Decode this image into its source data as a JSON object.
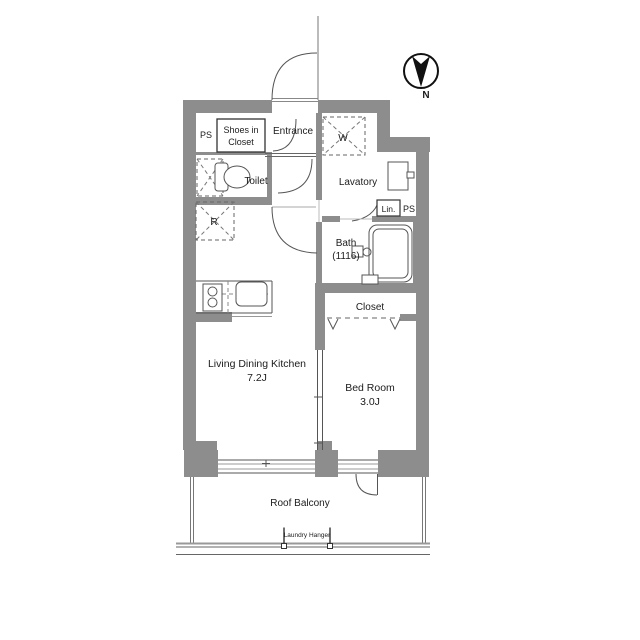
{
  "floorplan": {
    "colors": {
      "wall": "#8d8d8d",
      "line": "#555555",
      "text": "#1c1c1c"
    },
    "compass": {
      "label": "N"
    },
    "rooms": {
      "shoes_in_closet": {
        "line1": "Shoes in",
        "line2": "Closet"
      },
      "entrance": {
        "label": "Entrance"
      },
      "toilet": {
        "label": "Toilet"
      },
      "lavatory": {
        "label": "Lavatory"
      },
      "bath": {
        "line1": "Bath",
        "line2": "(1116)"
      },
      "closet": {
        "label": "Closet"
      },
      "ldk": {
        "line1": "Living Dining Kitchen",
        "line2": "7.2J"
      },
      "bedroom": {
        "line1": "Bed Room",
        "line2": "3.0J"
      },
      "balcony": {
        "label": "Roof Balcony"
      }
    },
    "annotations": {
      "ps_left": "PS",
      "ps_right": "PS",
      "linen": "Lin.",
      "washer": "W",
      "fridge": "R",
      "laundry_hanger": "Laundry Hanger"
    }
  }
}
